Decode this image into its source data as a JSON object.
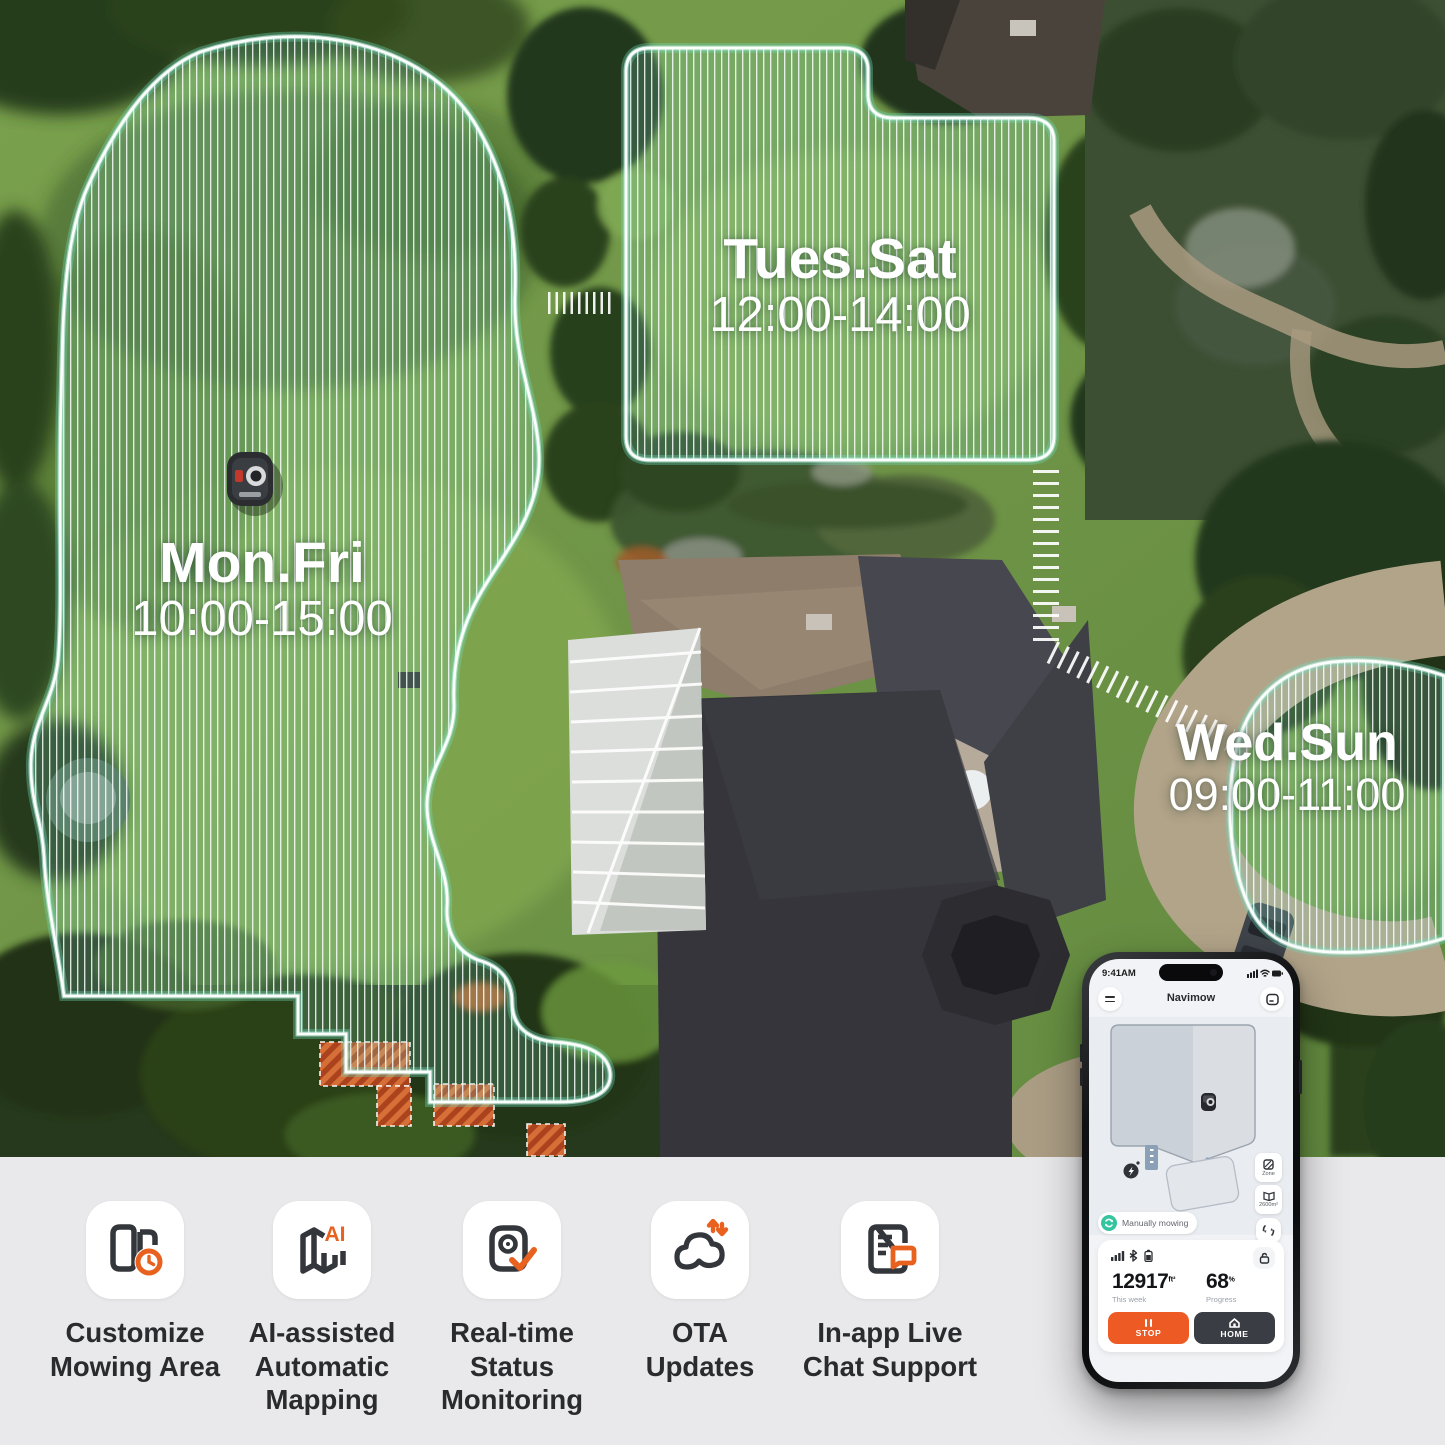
{
  "scene": {
    "zones": [
      {
        "days": "Mon.Fri",
        "time": "10:00-15:00"
      },
      {
        "days": "Tues.Sat",
        "time": "12:00-14:00"
      },
      {
        "days": "Wed.Sun",
        "time": "09:00-11:00"
      }
    ]
  },
  "phone": {
    "status_time": "9:41AM",
    "app_title": "Navimow",
    "map": {
      "zone_button_label": "Zone",
      "area_button_label": "2600m²"
    },
    "status_pill": "Manually mowing",
    "stats": {
      "area_value": "12917",
      "area_unit": "ft²",
      "area_caption": "This week",
      "progress_value": "68",
      "progress_unit": "%",
      "progress_caption": "Progress"
    },
    "buttons": {
      "stop": "STOP",
      "home": "HOME"
    }
  },
  "features": [
    {
      "icon": "zones-clock-icon",
      "lines": [
        "Customize",
        "Mowing Area"
      ]
    },
    {
      "icon": "map-ai-icon",
      "badge": "AI",
      "lines": [
        "AI-assisted",
        "Automatic",
        "Mapping"
      ]
    },
    {
      "icon": "camera-check-icon",
      "lines": [
        "Real-time",
        "Status",
        "Monitoring"
      ]
    },
    {
      "icon": "cloud-arrows-icon",
      "lines": [
        "OTA",
        "Updates"
      ]
    },
    {
      "icon": "doc-chat-icon",
      "lines": [
        "In-app Live",
        "Chat Support"
      ]
    }
  ],
  "colors": {
    "accent_orange": "#E8611F",
    "stop_button": "#EE5A24",
    "home_button": "#3A3E44",
    "teal_status": "#35C4A0",
    "zone_outline": "#FFFFFF",
    "zone_glow": "#7FDCC3",
    "bottom_bar_bg": "#E9E9EB"
  }
}
